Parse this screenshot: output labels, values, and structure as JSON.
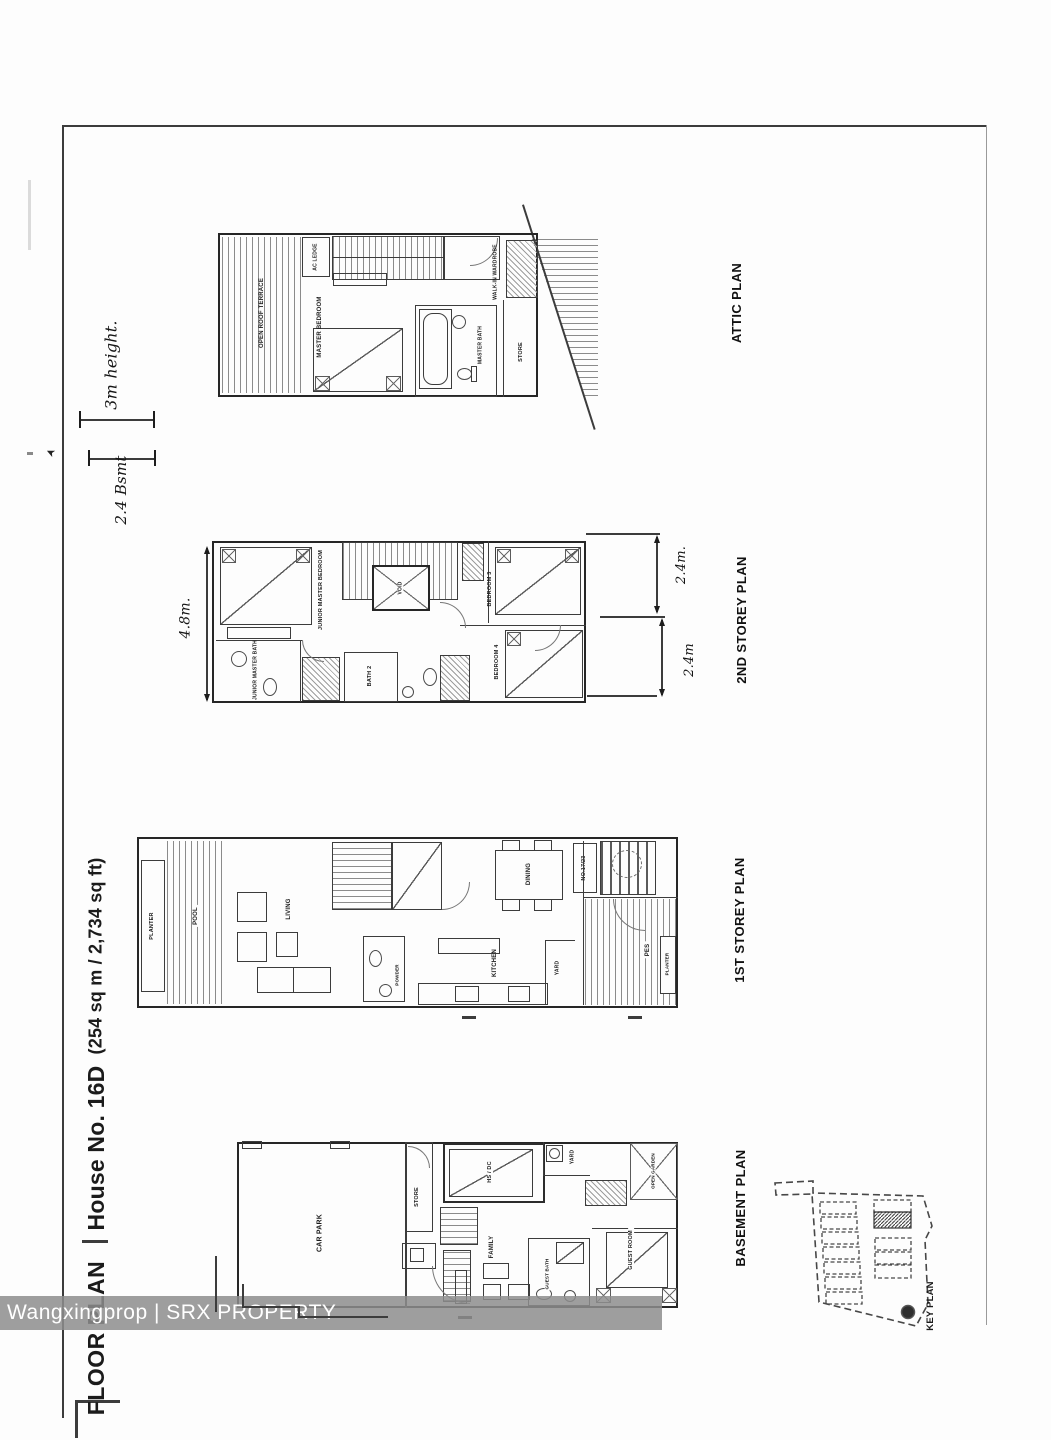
{
  "watermark": "Wangxingprop | SRX PROPERTY",
  "title": {
    "main": "FLOOR PLAN",
    "house": "House No. 16D",
    "area": "(254 sq m / 2,734 sq ft)"
  },
  "handwritten": {
    "height_note": "3m height.",
    "basement_note": "2.4 Bsmt",
    "dim_48": "4.8m.",
    "dim_24_top": "2.4m.",
    "dim_24_bottom": "2.4m"
  },
  "attic": {
    "title": "ATTIC PLAN",
    "open_roof_terrace": "OPEN ROOF TERRACE",
    "ac_ledge": "AC LEDGE",
    "master_bedroom": "MASTER BEDROOM",
    "master_bath": "MASTER BATH",
    "walk_in_wardrobe": "WALK-IN WARDROBE",
    "store": "STORE"
  },
  "second": {
    "title": "2ND STOREY PLAN",
    "junior_master_bedroom": "JUNIOR MASTER BEDROOM",
    "junior_master_bath": "JUNIOR MASTER BATH",
    "bath2": "BATH 2",
    "void": "VOID",
    "bedroom3": "BEDROOM 3",
    "bedroom4": "BEDROOM 4"
  },
  "first": {
    "title": "1ST STOREY PLAN",
    "planter_left": "PLANTER",
    "pool": "POOL",
    "living": "LIVING",
    "powder": "POWDER",
    "dining": "DINING",
    "kitchen": "KITCHEN",
    "yard": "YARD",
    "pes": "PES",
    "planter_right": "PLANTER",
    "lot_no": "NO.17/23"
  },
  "basement": {
    "title": "BASEMENT PLAN",
    "car_park": "CAR PARK",
    "store": "STORE",
    "hs": "HS / DC",
    "family": "FAMILY",
    "yard": "YARD",
    "open_garden": "OPEN GARDEN",
    "guest_bath": "GUEST BATH",
    "guest_room": "GUEST ROOM"
  },
  "key_plan": {
    "title": "KEY PLAN"
  }
}
